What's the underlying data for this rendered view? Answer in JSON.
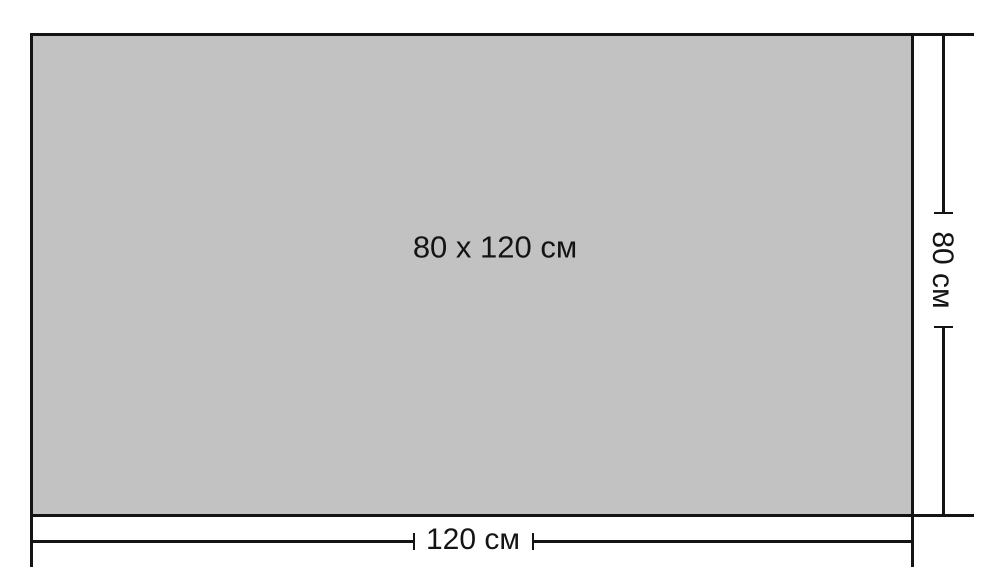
{
  "diagram": {
    "type": "dimension-drawing",
    "rectangle": {
      "center_label": "80 x 120 см",
      "width_cm": 120,
      "height_cm": 80
    },
    "dimensions": {
      "width_label": "120 см",
      "height_label": "80 см"
    },
    "colors": {
      "fill": "#c2c2c2",
      "line": "#141414",
      "background": "#ffffff"
    }
  }
}
